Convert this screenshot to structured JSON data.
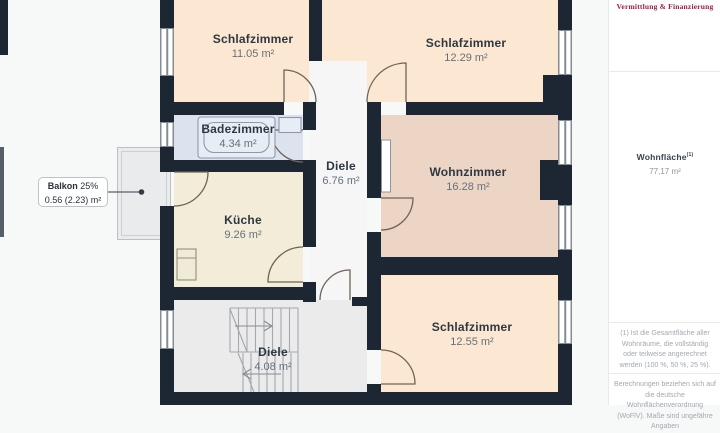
{
  "plan": {
    "rooms": [
      {
        "id": "schlafzimmer-1",
        "name": "Schlafzimmer",
        "area": "11.05 m²"
      },
      {
        "id": "schlafzimmer-2",
        "name": "Schlafzimmer",
        "area": "12.29 m²"
      },
      {
        "id": "badezimmer",
        "name": "Badezimmer",
        "area": "4.34 m²"
      },
      {
        "id": "diele-1",
        "name": "Diele",
        "area": "6.76 m²"
      },
      {
        "id": "wohnzimmer",
        "name": "Wohnzimmer",
        "area": "16.28 m²"
      },
      {
        "id": "kueche",
        "name": "Küche",
        "area": "9.26 m²"
      },
      {
        "id": "schlafzimmer-3",
        "name": "Schlafzimmer",
        "area": "12.55 m²"
      },
      {
        "id": "diele-2",
        "name": "Diele",
        "area": "4.08 m²"
      }
    ],
    "balcony": {
      "label": "Balkon",
      "percent": "25%",
      "area": "0.56 (2.23) m²"
    }
  },
  "sidebar": {
    "tagline": "Vermittlung & Finanzierung",
    "living_area": {
      "label": "Wohnfläche",
      "sup": "(1)",
      "value": "77,17 m²"
    },
    "footnotes": [
      "(1) Ist die Gesamtfläche aller Wohnräume, die vollständig oder teilweise angerechnet werden (100 %, 50 %, 25 %).",
      "Berechnungen beziehen sich auf die deutsche Wohnflächenverordnung (WoFlV). Maße sind ungefähre Angaben"
    ]
  },
  "colors": {
    "wall": "#1d2733",
    "bedroom": "#fce8d2",
    "living": "#edd5c6",
    "bath": "#dce3ef",
    "kitchen": "#f2ecd8",
    "hall": "#f5f6f5",
    "hall2": "#ebebec",
    "balcony": "#eaebec",
    "logo_accent": "#a01e3b"
  }
}
